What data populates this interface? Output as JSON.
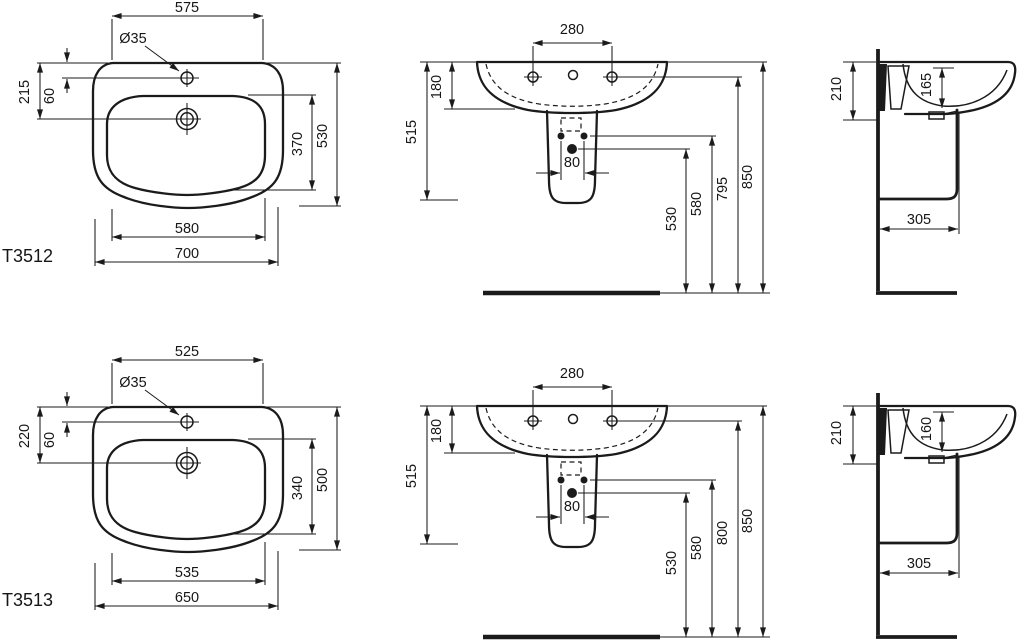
{
  "drawing": {
    "kind": "technical-dimension-drawing",
    "subject": "wall-hung washbasin with semi-pedestal, three orthographic views per model",
    "line_color": "#1b1b1b",
    "background": "#ffffff"
  },
  "models": {
    "t3512": {
      "code": "T3512",
      "plan": {
        "top_width": "575",
        "tap_hole_diameter": "Ø35",
        "rear_to_drain": "215",
        "rear_to_tap_hole": "60",
        "bowl_depth": "370",
        "overall_depth": "530",
        "bowl_width": "580",
        "overall_width": "700"
      },
      "front": {
        "tap_hole_spacing": "280",
        "rim_to_bowl_bottom": "180",
        "rim_to_pedestal_bottom": "515",
        "fixing_hole_spacing": "80",
        "floor_to_outlet": "530",
        "floor_to_fixing_holes": "580",
        "floor_to_tap_holes": "795",
        "floor_to_rim": "850"
      },
      "side": {
        "front_height": "210",
        "bowl_inner_depth": "165",
        "wall_to_pedestal_front": "305"
      }
    },
    "t3513": {
      "code": "T3513",
      "plan": {
        "top_width": "525",
        "tap_hole_diameter": "Ø35",
        "rear_to_drain": "220",
        "rear_to_tap_hole": "60",
        "bowl_depth": "340",
        "overall_depth": "500",
        "bowl_width": "535",
        "overall_width": "650"
      },
      "front": {
        "tap_hole_spacing": "280",
        "rim_to_bowl_bottom": "180",
        "rim_to_pedestal_bottom": "515",
        "fixing_hole_spacing": "80",
        "floor_to_outlet": "530",
        "floor_to_fixing_holes": "580",
        "floor_to_tap_holes": "800",
        "floor_to_rim": "850"
      },
      "side": {
        "front_height": "210",
        "bowl_inner_depth": "160",
        "wall_to_pedestal_front": "305"
      }
    }
  }
}
